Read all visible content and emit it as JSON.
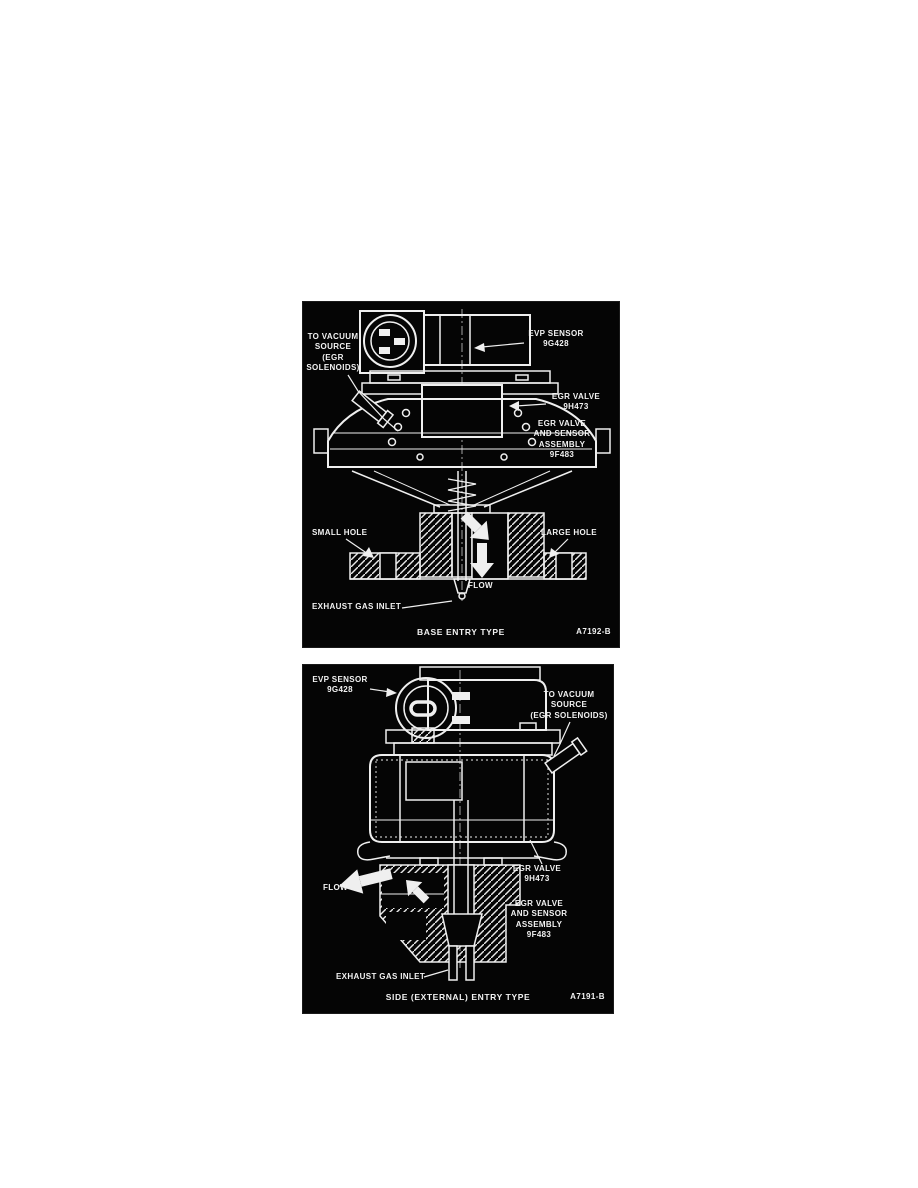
{
  "page": {
    "background": "#ffffff",
    "panel_background": "#050505",
    "line_color": "#f2f2f2"
  },
  "panels": [
    {
      "name": "base-entry",
      "caption": "BASE ENTRY TYPE",
      "figure_code": "A7192-B",
      "labels": {
        "vacuum_source": "TO VACUUM\nSOURCE\n(EGR\nSOLENOIDS)",
        "evp_sensor": "EVP SENSOR\n9G428",
        "egr_valve": "EGR VALVE\n9H473",
        "assembly": "EGR VALVE\nAND SENSOR\nASSEMBLY\n9F483",
        "small_hole": "SMALL HOLE",
        "large_hole": "LARGE HOLE",
        "flow": "FLOW",
        "exhaust_gas_inlet": "EXHAUST GAS INLET"
      }
    },
    {
      "name": "side-entry",
      "caption": "SIDE (EXTERNAL) ENTRY TYPE",
      "figure_code": "A7191-B",
      "labels": {
        "evp_sensor": "EVP SENSOR\n9G428",
        "vacuum_source": "TO VACUUM\nSOURCE\n(EGR SOLENOIDS)",
        "flow": "FLOW",
        "egr_valve": "EGR VALVE\n9H473",
        "assembly": "EGR VALVE\nAND SENSOR\nASSEMBLY\n9F483",
        "exhaust_gas_inlet": "EXHAUST GAS INLET"
      }
    }
  ]
}
